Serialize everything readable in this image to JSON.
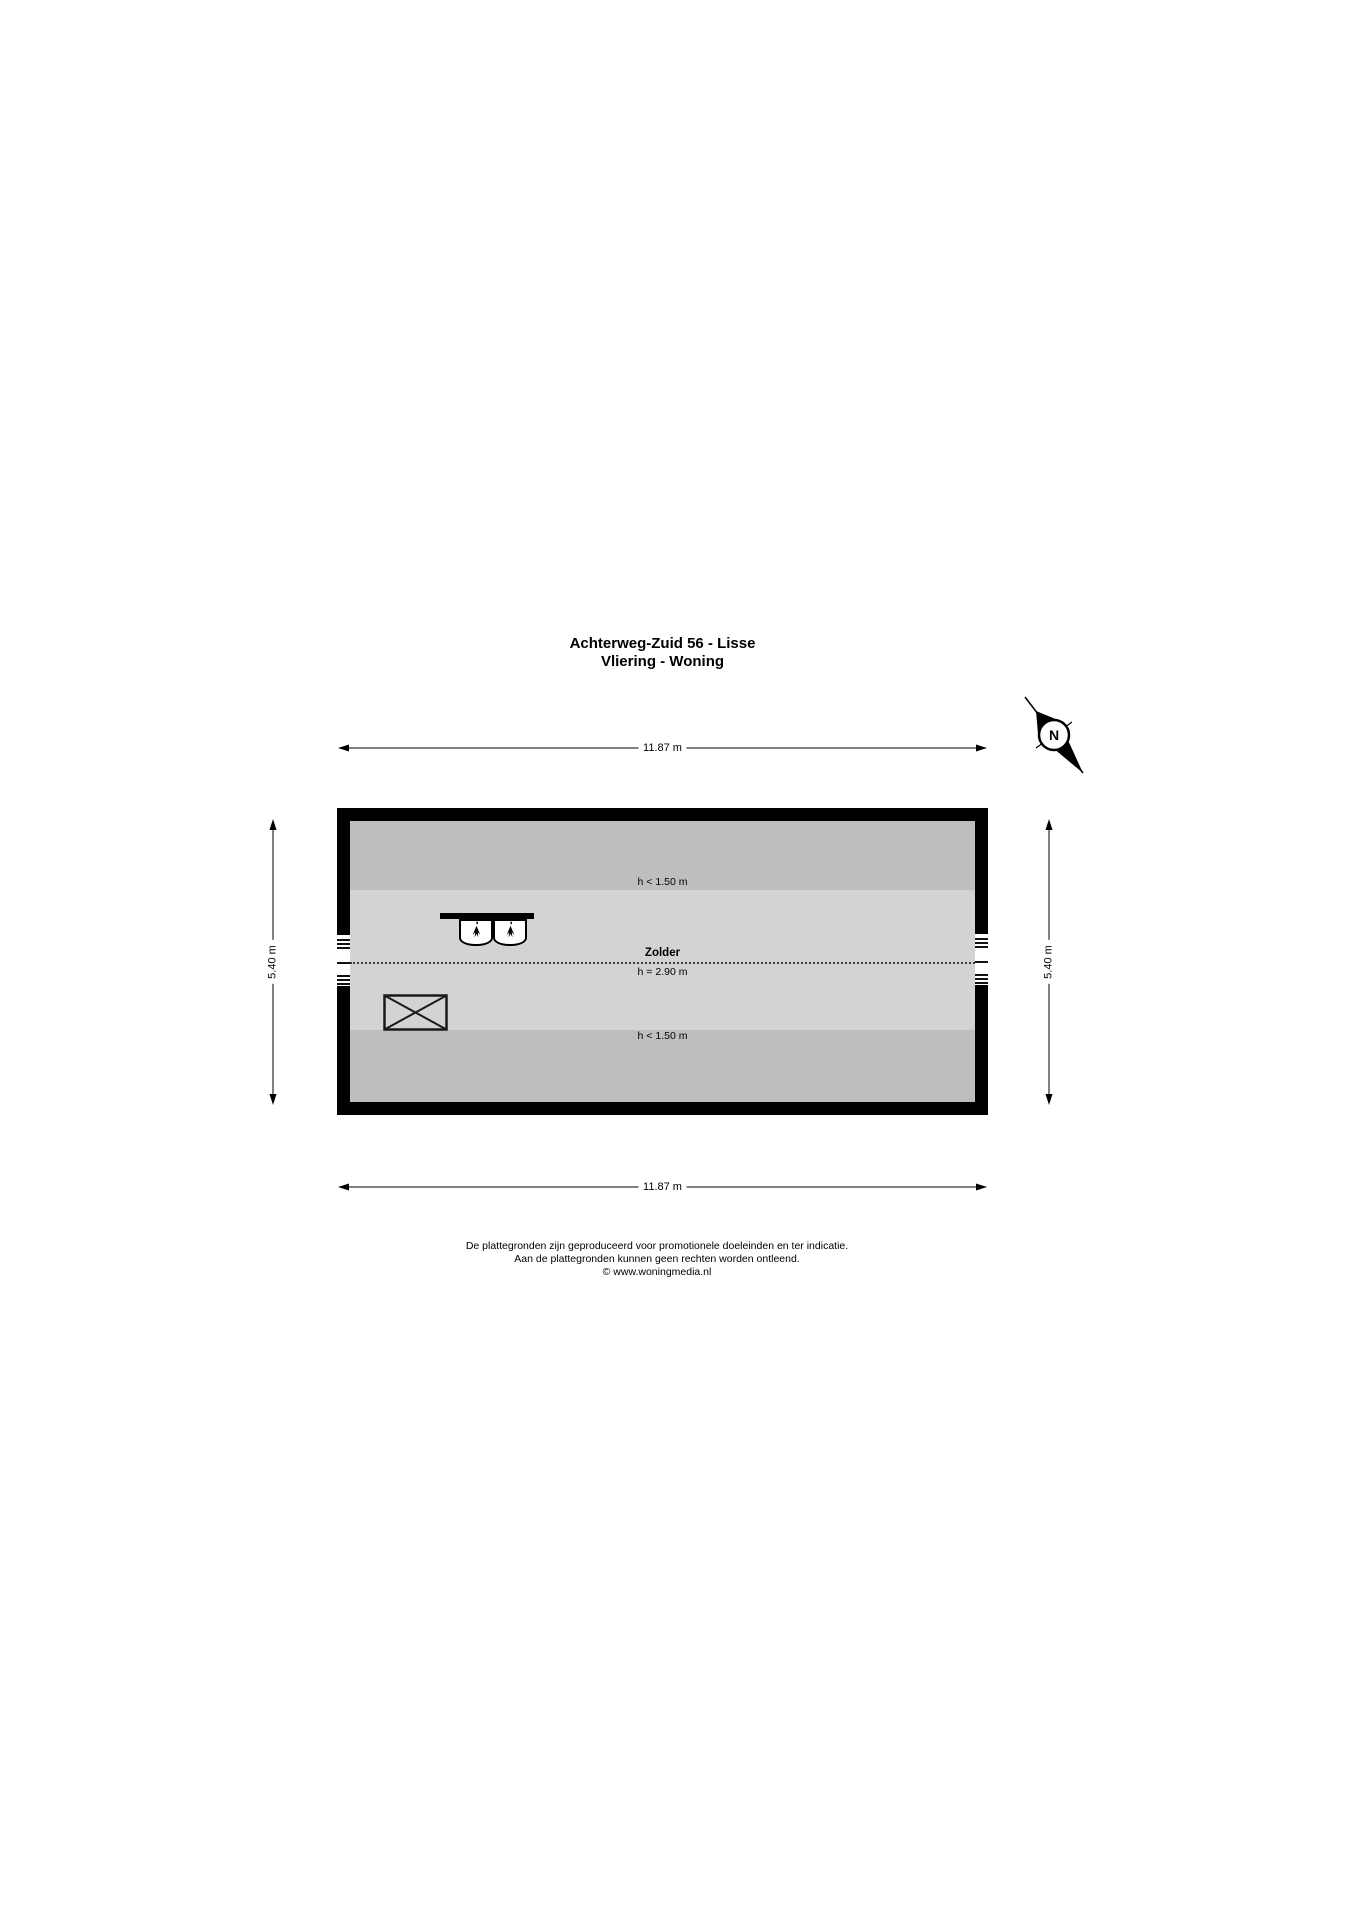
{
  "title": {
    "line1": "Achterweg-Zuid 56 - Lisse",
    "line2": "Vliering - Woning"
  },
  "dimensions": {
    "width_top": "11.87 m",
    "width_bottom": "11.87 m",
    "height_left": "5.40 m",
    "height_right": "5.40 m"
  },
  "plan": {
    "room_label": "Zolder",
    "room_height_label": "h = 2.90 m",
    "low_zone_top_label": "h < 1.50 m",
    "low_zone_bottom_label": "h < 1.50 m"
  },
  "compass": {
    "north_label": "N"
  },
  "footer": {
    "line1": "De plattegronden zijn geproduceerd voor promotionele doeleinden en ter indicatie.",
    "line2": "Aan de plattegronden kunnen geen rechten worden ontleend.",
    "line3": "© www.woningmedia.nl"
  },
  "colors": {
    "wall": "#000000",
    "floor": "#d3d3d3",
    "low_headroom_zone": "#bebebe",
    "background": "#ffffff"
  }
}
